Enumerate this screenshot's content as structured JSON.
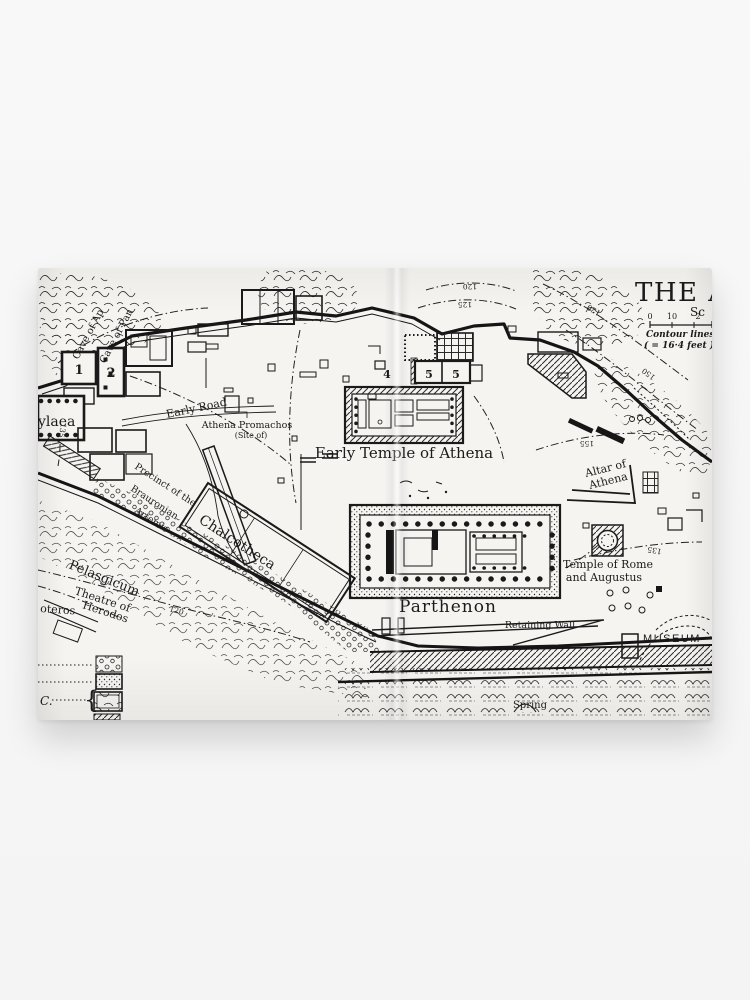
{
  "page": {
    "background_color": "#f6f6f6",
    "paper_color": "#f5f4f1",
    "ink_color": "#1b1b1b"
  },
  "map": {
    "title": "THE A",
    "scale_heading": "Sc",
    "scale_ticks": [
      "0",
      "10",
      "2"
    ],
    "contour_note_line1": "Contour lines",
    "contour_note_line2": "( = 16·4 feet )",
    "labels": {
      "cave_of_apollo": "Cave of Ap",
      "cave_of_pan": "Cave of Pan",
      "num_1": "1",
      "num_2": "2",
      "num_4": "4",
      "num_5a": "5",
      "num_5b": "5",
      "early_road": "Early Road",
      "propylaea_part": "ylaea",
      "athena_promachos": "Athena Promachos",
      "site_of": "(Site of)",
      "early_temple_of_athena": "Early Temple of Athena",
      "altar_of": "Altar of",
      "athena": "Athena",
      "precinct_1": "Precinct of the",
      "precinct_2": "Brauronian",
      "precinct_3": "Artemis",
      "chalcotheca": "Chalcotheca",
      "pelasgicum": "Pelasgicum",
      "theatre_of": "Theatre of",
      "herodes": "Herodes",
      "oteros": "oteros",
      "parthenon": "Parthenon",
      "retaining_wall": "Retaining Wall",
      "temple_of_rome": "Temple of Rome",
      "and_augustus": "and Augustus",
      "museum": "MUSEUM",
      "spring": "Spring",
      "legend_c": "C.",
      "legend_brace": "{"
    },
    "contour_values": {
      "top_a": "120",
      "top_b": "125",
      "right_a": "120",
      "right_b": "150",
      "mid": "155",
      "left": "135",
      "south": "120",
      "east": "135"
    }
  }
}
